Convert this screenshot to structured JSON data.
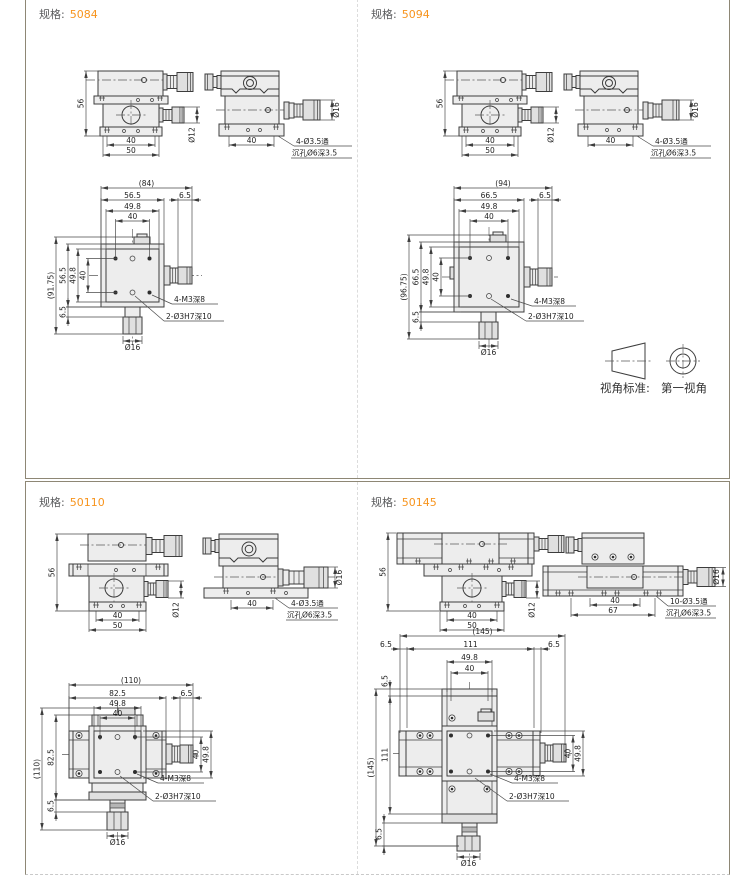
{
  "colors": {
    "accent": "#f7941d",
    "border": "#8e8775",
    "line": "#3d3d3d"
  },
  "view_standard": {
    "label": "视角标准:",
    "value": "第一视角"
  },
  "panels": [
    {
      "spec_label": "规格:",
      "spec_value": "5084",
      "front": {
        "height": "56",
        "span": "40",
        "base": "50",
        "dia": "Ø12"
      },
      "side": {
        "span": "40",
        "dia": "Ø16",
        "note1": "4-Ø3.5通",
        "note2": "沉孔Ø6深3.5"
      },
      "plan": {
        "ow": "(84)",
        "pw": "56.5",
        "sw": "49.8",
        "hw": "40",
        "ew": "6.5",
        "oh": "(91.75)",
        "ph": "56.5",
        "sh": "49.8",
        "hh": "40",
        "eh": "6.5",
        "dia": "Ø16",
        "note_thread": "4-M3深8",
        "note_pin": "2-Ø3H7深10"
      }
    },
    {
      "spec_label": "规格:",
      "spec_value": "5094",
      "front": {
        "height": "56",
        "span": "40",
        "base": "50",
        "dia": "Ø12"
      },
      "side": {
        "span": "40",
        "dia": "Ø16",
        "note1": "4-Ø3.5通",
        "note2": "沉孔Ø6深3.5"
      },
      "plan": {
        "ow": "(94)",
        "pw": "66.5",
        "sw": "49.8",
        "hw": "40",
        "ew": "6.5",
        "oh": "(96.75)",
        "ph": "66.5",
        "sh": "49.8",
        "hh": "40",
        "eh": "6.5",
        "dia": "Ø16",
        "note_thread": "4-M3深8",
        "note_pin": "2-Ø3H7深10"
      }
    },
    {
      "spec_label": "规格:",
      "spec_value": "50110",
      "front": {
        "height": "56",
        "span": "40",
        "base": "50",
        "dia": "Ø12"
      },
      "side": {
        "span": "40",
        "dia": "Ø16",
        "note1": "4-Ø3.5通",
        "note2": "沉孔Ø6深3.5"
      },
      "plan": {
        "ow": "(110)",
        "pw": "82.5",
        "sw": "49.8",
        "hw": "40",
        "ew": "6.5",
        "oh": "(110)",
        "ph": "82.5",
        "eh": "6.5",
        "rv_hole": "40",
        "rv_sub": "49.8",
        "dia": "Ø16",
        "note_thread": "4-M3深8",
        "note_pin": "2-Ø3H7深10"
      }
    },
    {
      "spec_label": "规格:",
      "spec_value": "50145",
      "front": {
        "height": "56",
        "span": "40",
        "base": "50",
        "dia": "Ø12"
      },
      "side": {
        "span": "40",
        "mount": "67",
        "dia": "Ø16",
        "note1": "10-Ø3.5通",
        "note2": "沉孔Ø6深3.5"
      },
      "plan": {
        "ow": "(145)",
        "pw": "111",
        "sw": "49.8",
        "hw": "40",
        "ew_l": "6.5",
        "ew_r": "6.5",
        "oh": "(145)",
        "ph": "111",
        "eh_t": "6.5",
        "eh_b": "6.5",
        "rv_hole": "40",
        "rv_sub": "49.8",
        "dia": "Ø16",
        "note_thread": "4-M3深8",
        "note_pin": "2-Ø3H7深10"
      }
    }
  ]
}
